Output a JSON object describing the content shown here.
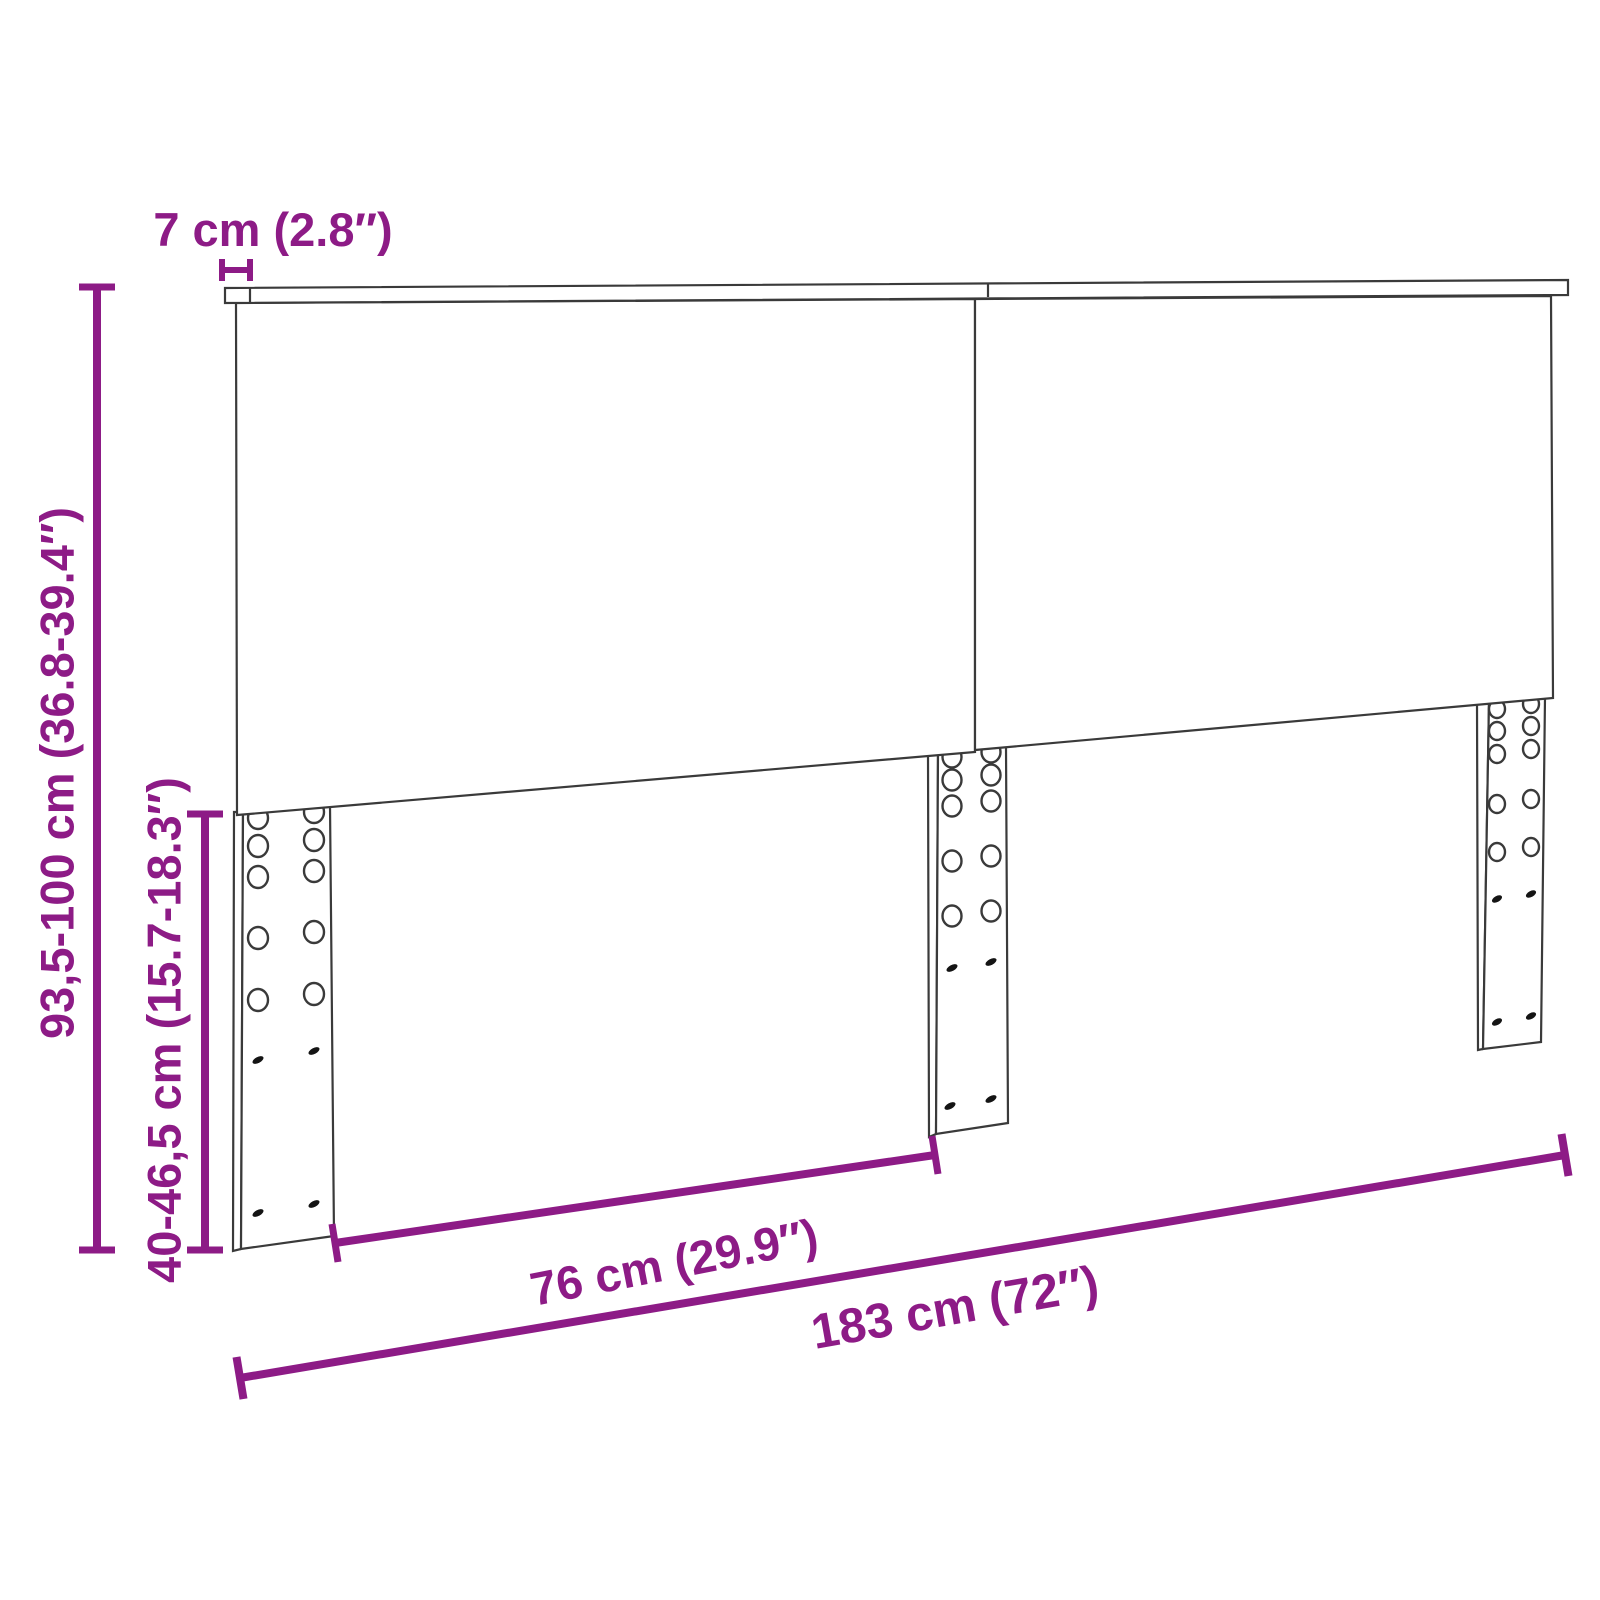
{
  "diagram": {
    "subject": "headboard-dimension-drawing",
    "colors": {
      "accent": "#8d1b86",
      "line": "#3a3a3a",
      "background": "#ffffff"
    },
    "counts": {
      "panels": 2,
      "legs": 3
    },
    "dimensions": {
      "thickness": {
        "label": "7 cm (2.8″)"
      },
      "height": {
        "label": "93,5-100 cm (36.8-39.4″)"
      },
      "leg_height": {
        "label": "40-46,5 cm (15.7-18.3″)"
      },
      "leg_spacing": {
        "label": "76 cm (29.9″)"
      },
      "width": {
        "label": "183 cm (72″)"
      }
    }
  }
}
